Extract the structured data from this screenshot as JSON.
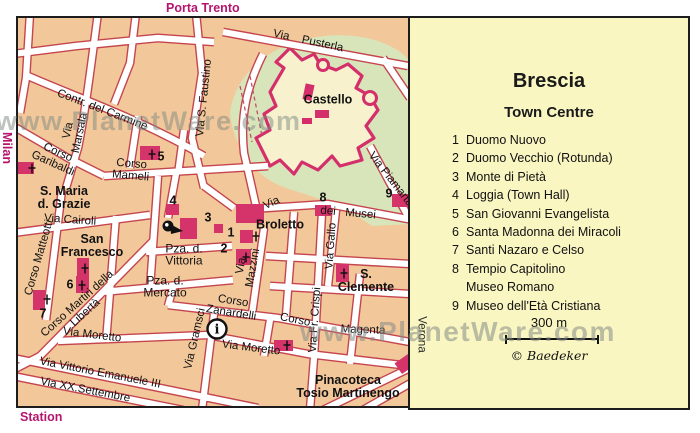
{
  "labels_outside": {
    "porta_trento": "Porta Trento",
    "milan": "Milan",
    "station": "Station",
    "verona": "Verona"
  },
  "watermarks": {
    "top_left": "www.PlanetWare.com",
    "bottom_right": "www.PlanetWare.com"
  },
  "legend": {
    "title": "Brescia",
    "subtitle": "Town Centre",
    "items": [
      {
        "num": "1",
        "label": "Duomo Nuovo"
      },
      {
        "num": "2",
        "label": "Duomo Vecchio (Rotunda)"
      },
      {
        "num": "3",
        "label": "Monte di Pietà"
      },
      {
        "num": "4",
        "label": "Loggia (Town Hall)"
      },
      {
        "num": "5",
        "label": "San Giovanni Evangelista"
      },
      {
        "num": "6",
        "label": "Santa Madonna dei Miracoli"
      },
      {
        "num": "7",
        "label": "Santi Nazaro e Celso"
      },
      {
        "num": "8",
        "label": "Tempio Capitolino",
        "label2": "Museo Romano"
      },
      {
        "num": "9",
        "label": "Museo dell'Età Cristiana"
      }
    ],
    "scale_label": "300 m",
    "copyright": "© Baedeker"
  },
  "map": {
    "street_labels": [
      {
        "t": "Contr. del Carmine",
        "x": 84,
        "y": 93,
        "r": 21
      },
      {
        "t": "Via\nMarsala",
        "x": 57,
        "y": 114,
        "r": -78
      },
      {
        "t": "Via S. Faustino",
        "x": 187,
        "y": 80,
        "r": -84
      },
      {
        "t": "Via    Pusterla",
        "x": 290,
        "y": 24,
        "r": 12
      },
      {
        "t": "Corso\nGaribaldi",
        "x": 37,
        "y": 141,
        "r": 24
      },
      {
        "t": "Corso\nMameli",
        "x": 113,
        "y": 153,
        "r": 5
      },
      {
        "t": "Via Cairoli",
        "x": 52,
        "y": 203,
        "r": 4
      },
      {
        "t": "Corso Matteotti",
        "x": 22,
        "y": 240,
        "r": -74
      },
      {
        "t": "Corso Martiri della\nLibertà",
        "x": 64,
        "y": 291,
        "r": -42
      },
      {
        "t": "Via Moretto",
        "x": 74,
        "y": 318,
        "r": 7
      },
      {
        "t": "Via Moretto",
        "x": 233,
        "y": 331,
        "r": 7
      },
      {
        "t": "Via Vittorio Emanuele III",
        "x": 82,
        "y": 356,
        "r": 11
      },
      {
        "t": "Via XX.Settembre",
        "x": 67,
        "y": 373,
        "r": 11
      },
      {
        "t": "Via Gramsci",
        "x": 178,
        "y": 321,
        "r": -77
      },
      {
        "t": "Via\nMazzini",
        "x": 230,
        "y": 249,
        "r": -80
      },
      {
        "t": "Corso\nZanardelli",
        "x": 214,
        "y": 290,
        "r": 9
      },
      {
        "t": "Corso",
        "x": 277,
        "y": 303,
        "r": 11
      },
      {
        "t": "Magenta",
        "x": 345,
        "y": 313,
        "r": 2
      },
      {
        "t": "Via",
        "x": 254,
        "y": 186,
        "r": -25
      },
      {
        "t": "dei   Musei",
        "x": 330,
        "y": 196,
        "r": 5
      },
      {
        "t": "Via Piamarta",
        "x": 372,
        "y": 162,
        "r": 52
      },
      {
        "t": "Via Gallo",
        "x": 314,
        "y": 228,
        "r": -86
      },
      {
        "t": "Via Fr. Crispi",
        "x": 298,
        "y": 302,
        "r": -86
      }
    ],
    "place_labels": [
      {
        "t": "S. Maria\nd. Grazie",
        "x": 46,
        "y": 180
      },
      {
        "t": "San\nFrancesco",
        "x": 74,
        "y": 228
      },
      {
        "t": "Broletto",
        "x": 262,
        "y": 207
      },
      {
        "t": "Castello",
        "x": 310,
        "y": 82
      },
      {
        "t": "S.\nClemente",
        "x": 348,
        "y": 263
      },
      {
        "t": "Pinacoteca\nTosio Martinengo",
        "x": 330,
        "y": 369
      },
      {
        "t": "Pza. d.\nVittoria",
        "x": 166,
        "y": 237,
        "regular": true
      },
      {
        "t": "Pza. d.\nMercato",
        "x": 147,
        "y": 269,
        "regular": true
      }
    ],
    "markers": [
      {
        "n": "1",
        "x": 213,
        "y": 215
      },
      {
        "n": "2",
        "x": 206,
        "y": 231
      },
      {
        "n": "3",
        "x": 190,
        "y": 200
      },
      {
        "n": "4",
        "x": 155,
        "y": 183
      },
      {
        "n": "5",
        "x": 143,
        "y": 139
      },
      {
        "n": "6",
        "x": 52,
        "y": 267
      },
      {
        "n": "7",
        "x": 25,
        "y": 296
      },
      {
        "n": "8",
        "x": 305,
        "y": 180
      },
      {
        "n": "9",
        "x": 371,
        "y": 176
      }
    ]
  },
  "colors": {
    "map_background": "#f2c89b",
    "street_border": "#c5454e",
    "building": "#d5346b",
    "castle_outline": "#d42f6b",
    "castle_fill": "#f7f2cd",
    "park": "#d8e5bb",
    "panel_background": "#f9f6c2",
    "magenta_label": "#b5156e",
    "watermark": "#8a928e"
  }
}
